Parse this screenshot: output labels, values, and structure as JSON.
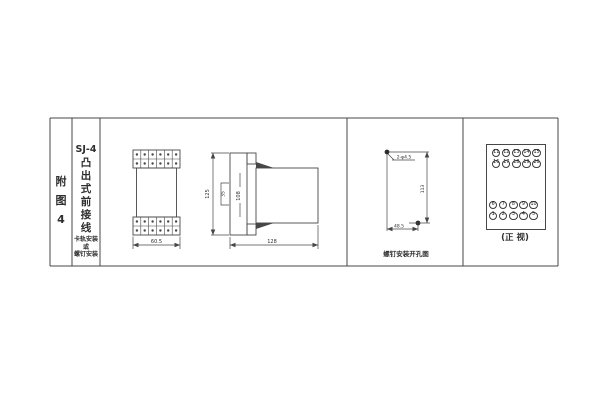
{
  "figure": {
    "index_label": "附\n图\n4",
    "model": "SJ-4",
    "type_label": "凸\n出\n式\n前\n接\n线",
    "mounting_note": "卡轨安装\n或\n螺钉安装"
  },
  "front_view": {
    "width_dim": "60.5"
  },
  "side_view": {
    "height_dim": "125",
    "rail_dim": "35",
    "body_dim": "108",
    "depth_dim": "128"
  },
  "drill_view": {
    "hole_label": "2-φ4.5",
    "vertical_dim": "113",
    "horizontal_dim": "48.5",
    "caption": "螺钉安装开孔图"
  },
  "terminal_view": {
    "caption": "(正 视)",
    "top_row1": [
      "11",
      "12",
      "13",
      "14",
      "15"
    ],
    "top_row2": [
      "16",
      "17",
      "18",
      "19",
      "20"
    ],
    "bottom_row1": [
      "6",
      "7",
      "8",
      "9",
      "10"
    ],
    "bottom_row2": [
      "1",
      "2",
      "3",
      "4",
      "5"
    ]
  },
  "colors": {
    "line": "#474747",
    "text": "#2e2e2e",
    "background": "#ffffff"
  }
}
